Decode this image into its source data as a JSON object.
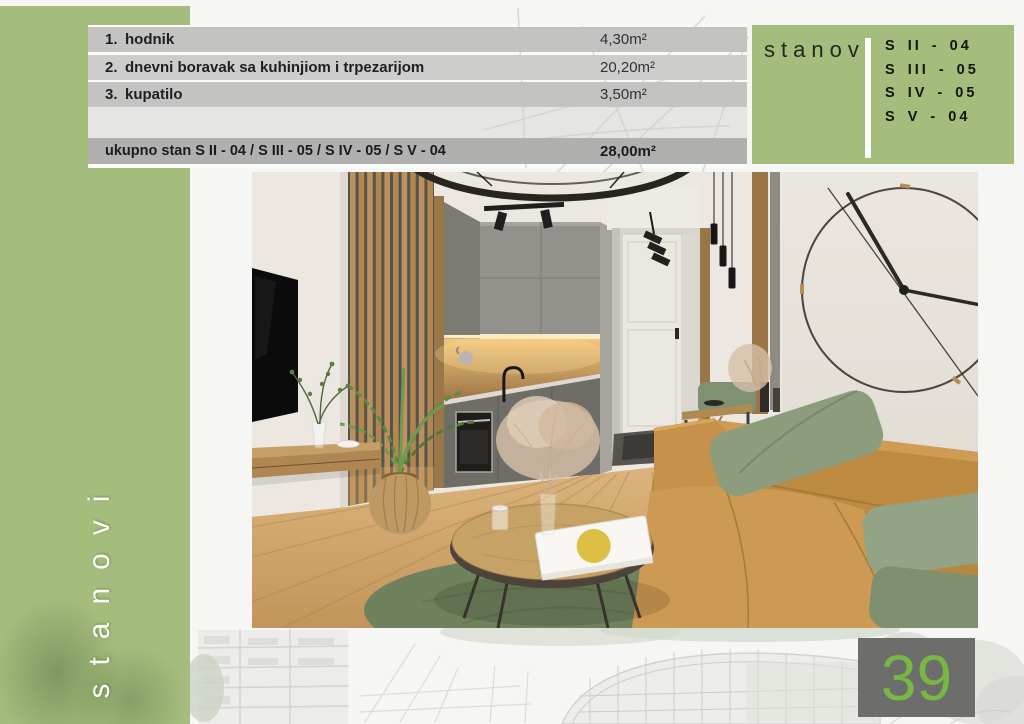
{
  "page": {
    "number": "39"
  },
  "sidebar": {
    "vertical_label": "stanovi"
  },
  "room_table": {
    "rows": [
      {
        "num": "1.",
        "label": "hodnik",
        "area": "4,30m²"
      },
      {
        "num": "2.",
        "label": "dnevni boravak sa kuhinjiom i trpezarijom",
        "area": "20,20m²"
      },
      {
        "num": "3.",
        "label": "kupatilo",
        "area": "3,50m²"
      }
    ],
    "total_label": "ukupno stan S II - 04 / S III - 05 / S IV - 05 / S V - 04",
    "total_area": "28,00m²"
  },
  "units_panel": {
    "title": "stanovi",
    "units": [
      "S II - 04",
      "S III - 05",
      "S IV - 05",
      "S V - 04"
    ]
  },
  "photo": {
    "description": "interior render of living room with kitchen, tan leather sofa, wood slat wall, round coffee table and wall clock"
  },
  "colors": {
    "accent_green": "#a4bd7c",
    "page_number_green": "#77b743",
    "row_gray": "#c3c3c2",
    "row_gray_alt": "#cdcdcc",
    "total_row_gray": "#b0b0af"
  }
}
